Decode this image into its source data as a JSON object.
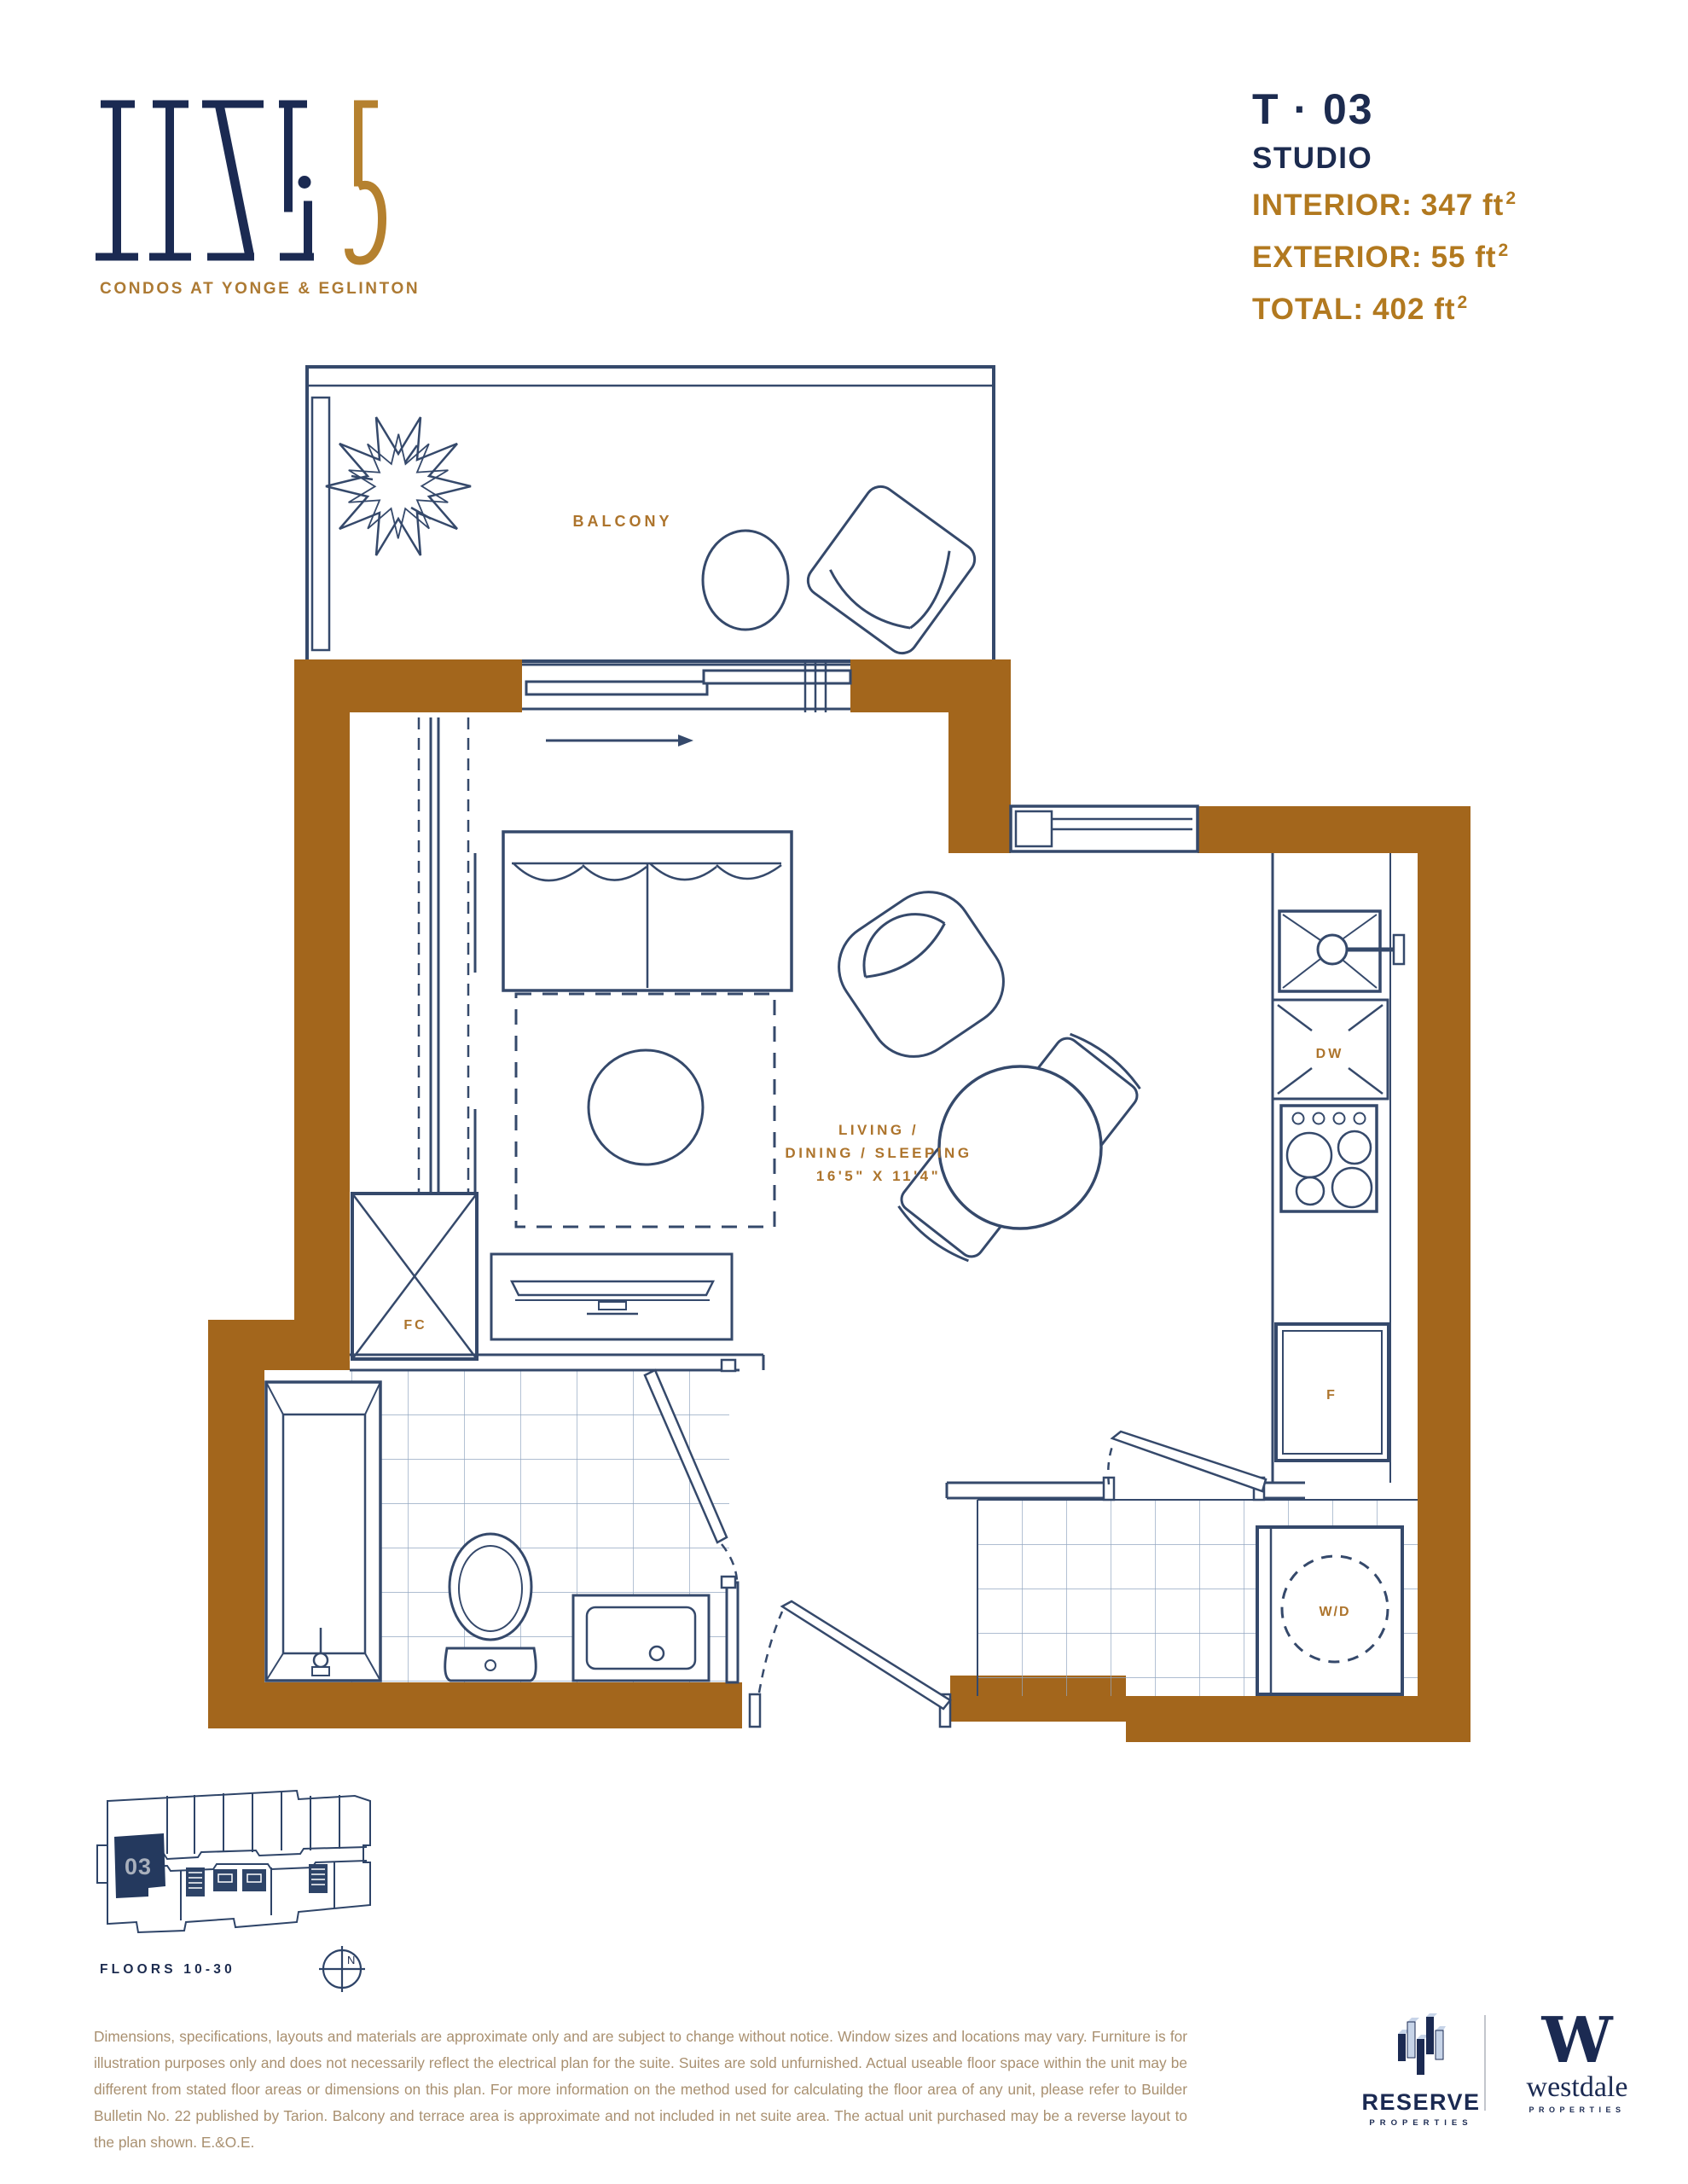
{
  "colors": {
    "navy": "#1C2B4F",
    "gold_label": "#AD742C",
    "gold_area": "#B2791F",
    "wall_brown": "#A3661C",
    "plan_line": "#35496B",
    "tile_line": "#93A7C2",
    "disclaimer_text": "#A99070"
  },
  "brand": {
    "wordmark": "LINE 5",
    "tagline": "CONDOS AT YONGE & EGLINTON"
  },
  "unit": {
    "code": "T · 03",
    "type": "STUDIO",
    "areas": [
      {
        "label": "INTERIOR:",
        "value": "347 ft",
        "sup": "2"
      },
      {
        "label": "EXTERIOR:",
        "value": "55 ft",
        "sup": "2"
      },
      {
        "label": "TOTAL:",
        "value": "402 ft",
        "sup": "2"
      }
    ]
  },
  "plan": {
    "balcony": "BALCONY",
    "living_line1": "LIVING /",
    "living_line2": "DINING / SLEEPING",
    "living_dims": "16'5\" X 11'4\"",
    "fan_coil": "FC",
    "dishwasher": "DW",
    "fridge": "F",
    "washer_dryer": "W/D"
  },
  "keyplan": {
    "unit": "03",
    "floors": "FLOORS 10-30",
    "north": "N"
  },
  "disclaimer": "Dimensions, specifications, layouts and materials are approximate only and are subject to change without notice. Window sizes and locations may vary. Furniture is for illustration purposes only and does not necessarily reflect the electrical plan for the suite. Suites are sold unfurnished. Actual useable floor space within the unit may be different from stated floor areas or dimensions on this plan. For more information on the method used for calculating the floor area of any unit, please refer to Builder Bulletin No. 22 published by Tarion. Balcony and terrace area is approximate and not included in net suite area. The actual unit purchased may be a reverse layout to the plan shown. E.&O.E.",
  "footer": {
    "reserve": "RESERVE",
    "reserve_sub": "PROPERTIES",
    "westdale_mark": "W",
    "westdale": "westdale",
    "westdale_sub": "PROPERTIES"
  }
}
